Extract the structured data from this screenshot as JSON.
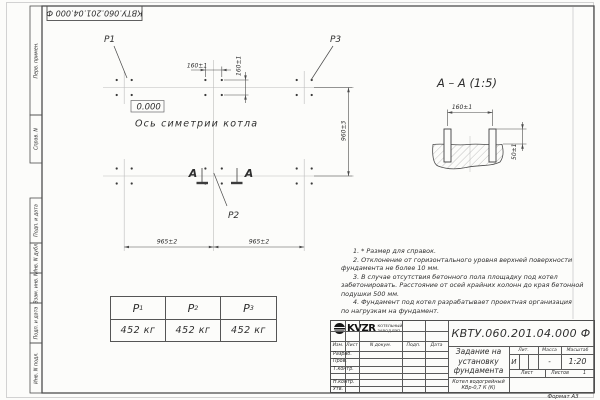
{
  "frame": {
    "stamp_top": "КВТУ.060.201.04.000  Ф",
    "format_label": "Формат А3",
    "margin_labels": [
      "Перв. примен.",
      "Справ. N",
      "Подп. и дата",
      "Инв. N дубл.",
      "Взам. инв. N",
      "Подп. и дата",
      "Инв. N подл."
    ]
  },
  "plan": {
    "p1": "P1",
    "p2": "P2",
    "p3": "P3",
    "elevation": "0.000",
    "axis_label": "Ось симетрии котла",
    "dim_160_h": "160±1",
    "dim_160_v": "160±1",
    "dim_960": "960±3",
    "dim_965_left": "965±2",
    "dim_965_right": "965±2",
    "section_letter_left": "А",
    "section_letter_right": "А"
  },
  "section": {
    "title": "А – А (1:5)",
    "dim_160": "160±1",
    "dim_50": "50±1"
  },
  "load_table": {
    "columns": [
      {
        "name": "P",
        "sub": "1",
        "value": "452 кг"
      },
      {
        "name": "P",
        "sub": "2",
        "value": "452 кг"
      },
      {
        "name": "P",
        "sub": "3",
        "value": "452 кг"
      }
    ]
  },
  "notes": {
    "lines": [
      {
        "text": "1. * Размер для справок."
      },
      {
        "text": "2. Отклонение от горизонтального уровня верхней поверхности"
      },
      {
        "text": "фундамента не более 10 мм."
      },
      {
        "text": "3. В случае отсутствия бетонного пола площадку под котел"
      },
      {
        "text": "забетонировать. Расстояние от осей крайних колонн до края бетонной"
      },
      {
        "text": "подушки 500 мм."
      },
      {
        "text": "4. Фундамент под котел разрабатывает проектная организация"
      },
      {
        "text": "по нагрузкам на фундамент."
      }
    ]
  },
  "title_block": {
    "doc_number": "КВТУ.060.201.04.000  Ф",
    "title_line1": "Задание на",
    "title_line2": "установку",
    "title_line3": "фундамента",
    "subtitle_line1": "Котел водогрейный",
    "subtitle_line2": "КВр-0,7 К (К)",
    "col_izm": "Изм.",
    "col_list": "Лист",
    "col_doc": "N докум.",
    "col_podp": "Подп.",
    "col_data": "Дата",
    "row_razrab": "Разраб.",
    "row_prov": "Пров.",
    "row_tkontr": "Т.контр.",
    "row_nkontr": "Н.контр.",
    "row_utv": "Утв.",
    "lit_header": "Лит.",
    "mass_header": "Масса",
    "scale_header": "Масштаб",
    "lit_value": "И",
    "mass_value": "-",
    "scale_value": "1:20",
    "sheet_label": "Лист",
    "sheets_label": "Листов",
    "sheets_value": "1",
    "logo_text": "KVZR",
    "logo_line1": "КОТЕЛЬНЫЙ",
    "logo_line2": "ЗАВОД РЭП"
  }
}
